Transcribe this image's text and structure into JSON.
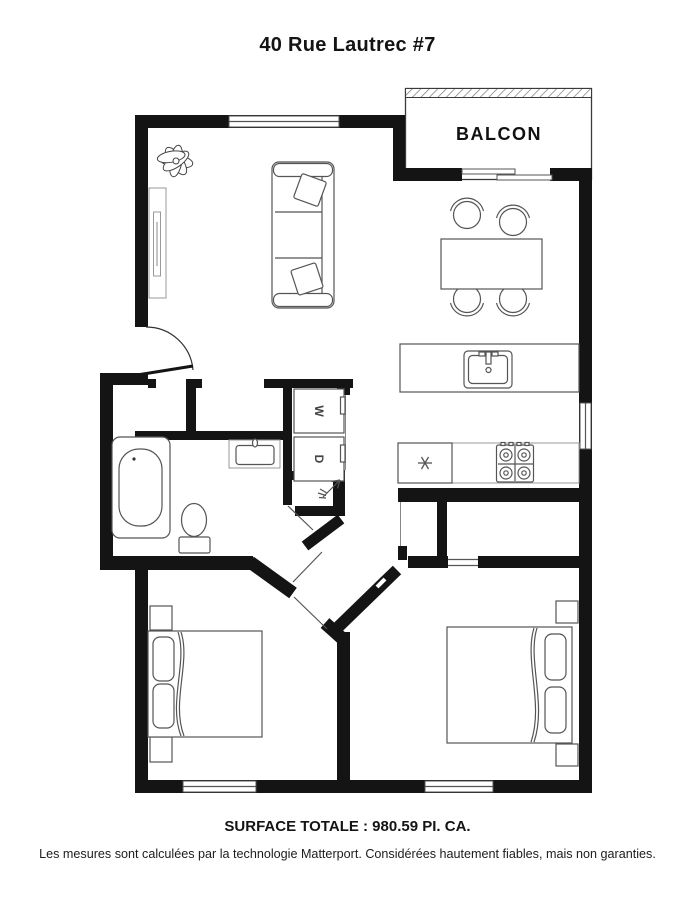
{
  "header": {
    "title": "40 Rue Lautrec #7"
  },
  "plan": {
    "balcony_label": "BALCON",
    "washer_label": "W",
    "dryer_label": "D",
    "colors": {
      "walls": "#141414",
      "furniture_stroke": "#555555",
      "background": "#ffffff"
    }
  },
  "footer": {
    "total_area": "SURFACE TOTALE : 980.59 PI. CA.",
    "disclaimer": "Les mesures sont calculées par la technologie Matterport. Considérées hautement fiables, mais non garanties."
  }
}
